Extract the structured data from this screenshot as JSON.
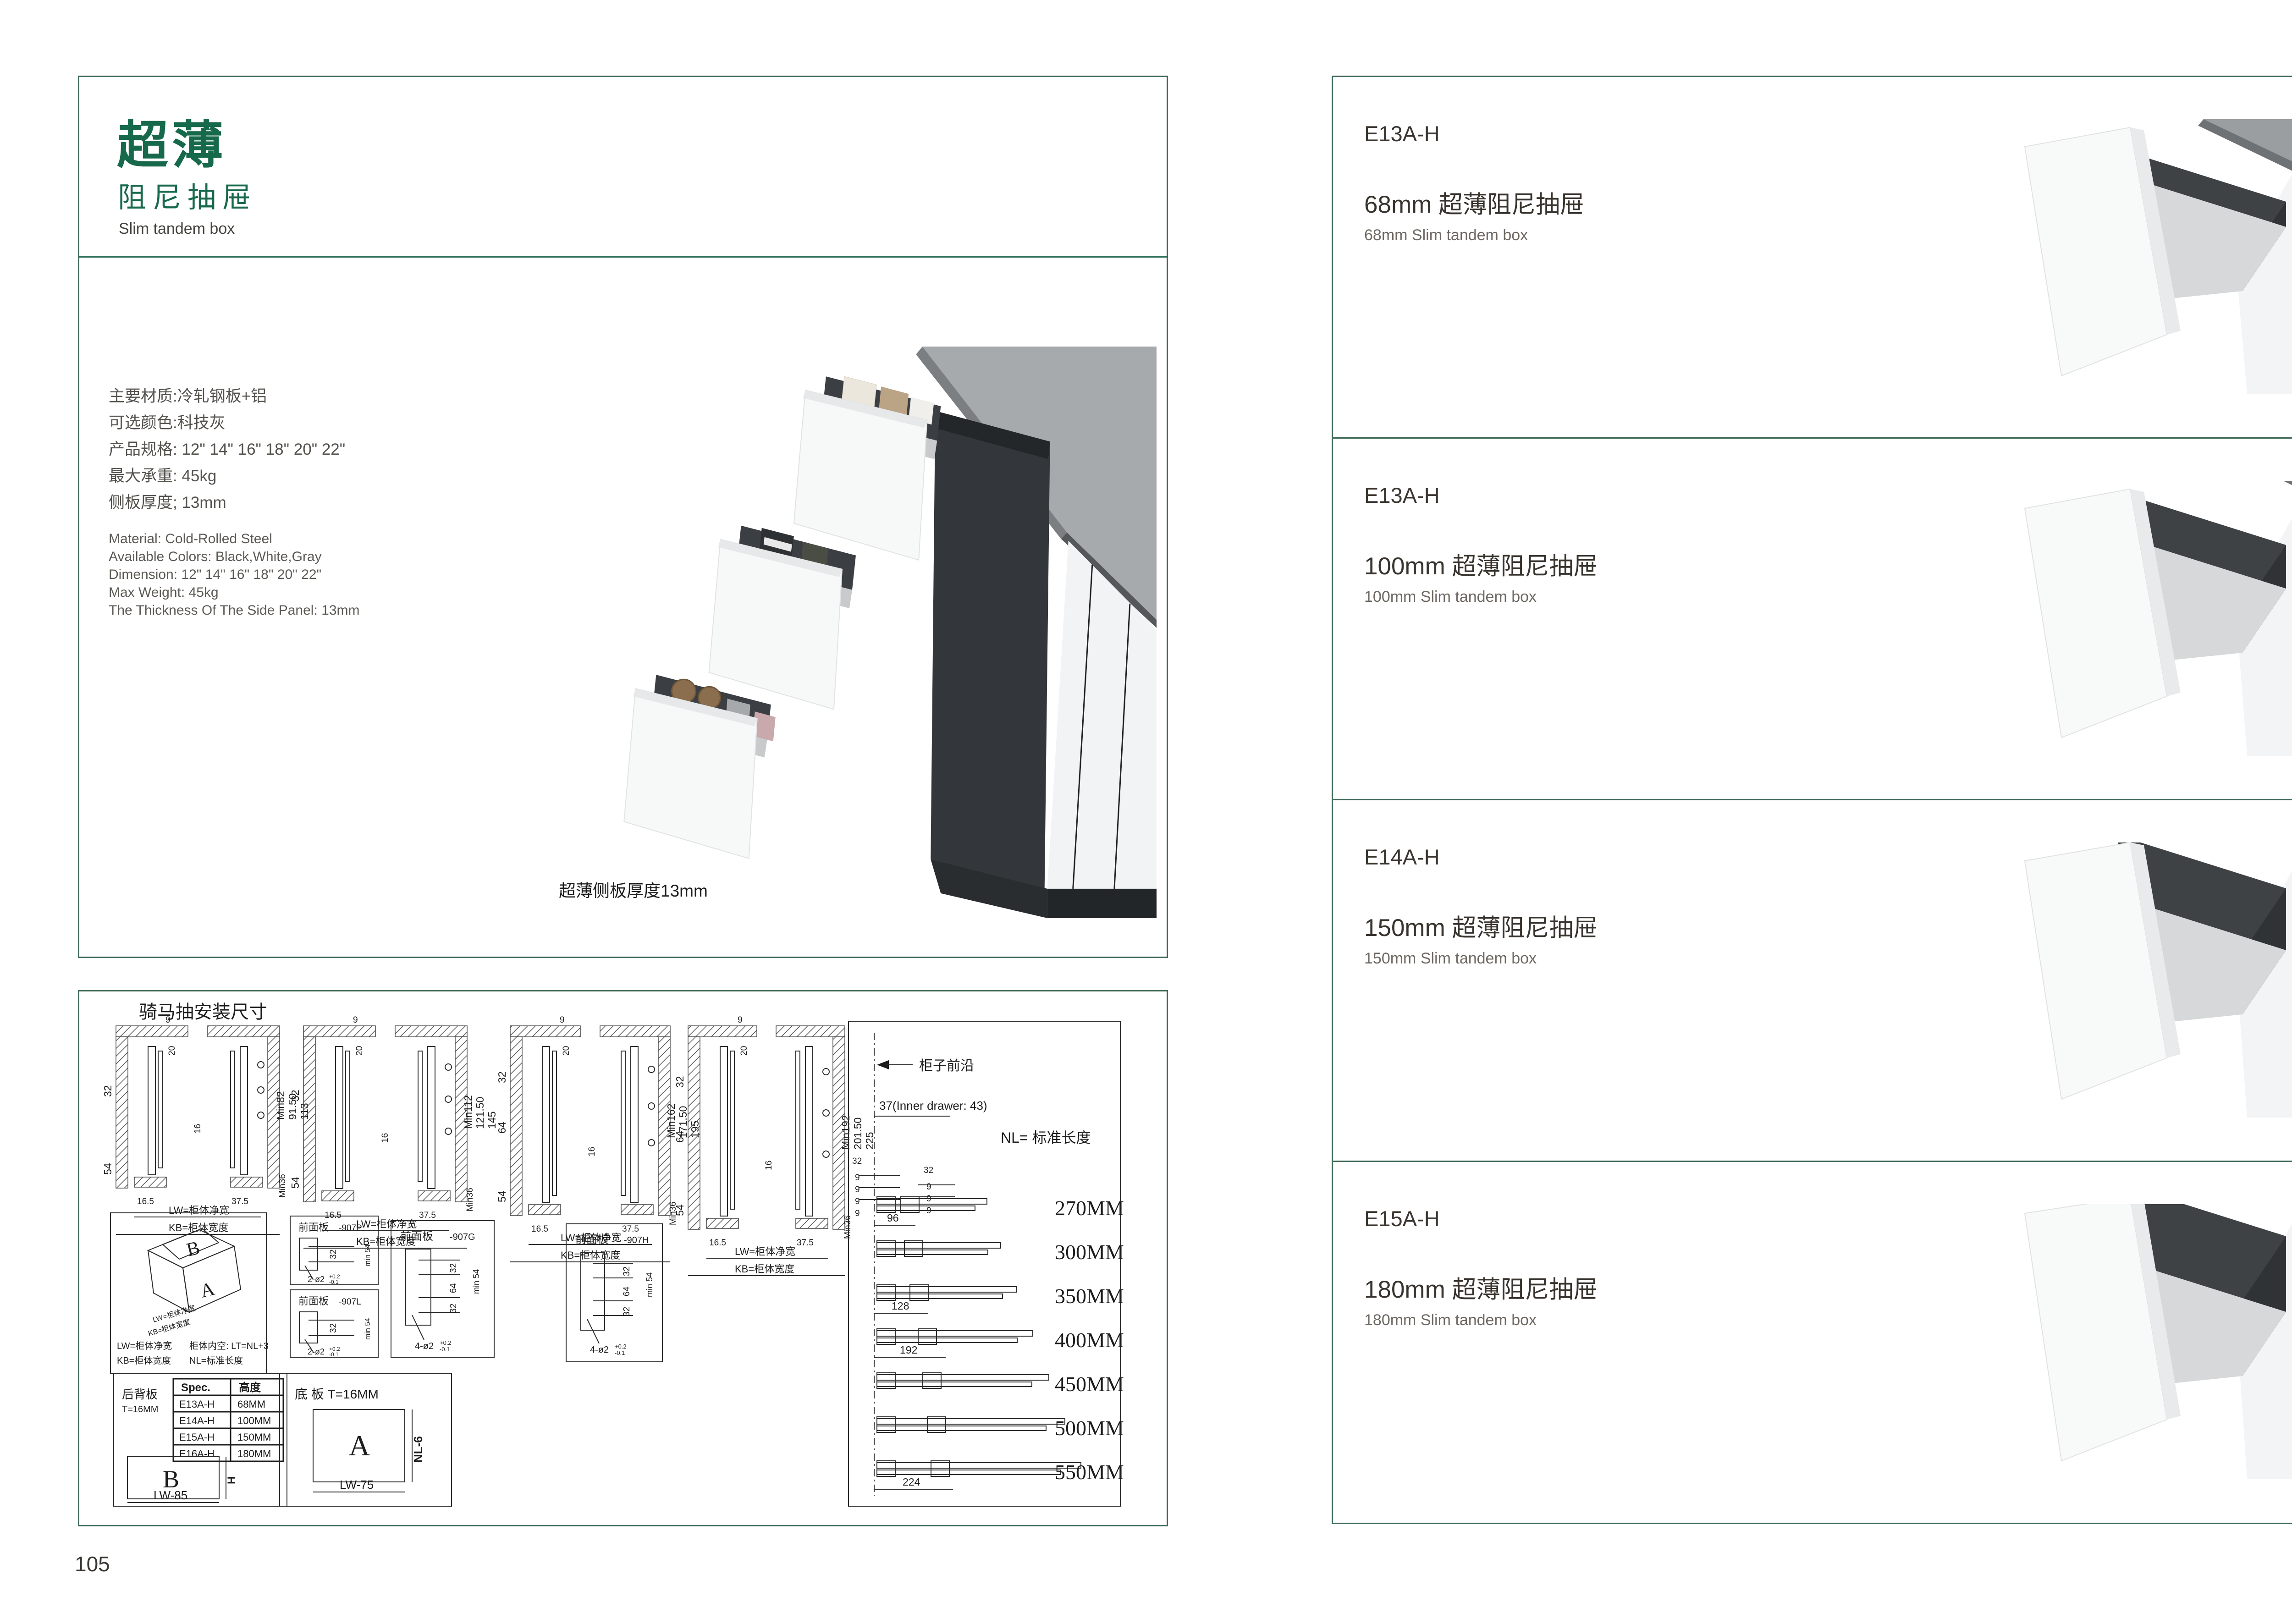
{
  "colors": {
    "green": "#17694B",
    "border_line": "#3f6b58",
    "drawer_dark": "#33373b",
    "counter_gray": "#a7aaac"
  },
  "page_left": {
    "page_number": "105",
    "header": {
      "title_cn_big": "超薄",
      "title_cn_sub": "阻尼抽屉",
      "title_en": "Slim tandem box"
    },
    "specs_cn": [
      "主要材质:冷轧钢板+铝",
      "可选颜色:科技灰",
      "产品规格: 12\" 14\" 16\" 18\" 20\" 22\"",
      "最大承重: 45kg",
      "侧板厚度; 13mm"
    ],
    "specs_en": [
      "Material: Cold-Rolled Steel",
      "Available Colors: Black,White,Gray",
      "Dimension: 12\" 14\" 16\" 18\" 20\" 22\"",
      "Max Weight: 45kg",
      "The Thickness Of The Side Panel: 13mm"
    ],
    "photo_caption": "超薄侧板厚度13mm",
    "diagram": {
      "title": "骑马抽安装尺寸",
      "cross_sections": [
        {
          "h1": "Min82",
          "h2": "91.50",
          "h3": "113",
          "d9": "9",
          "d20": "20",
          "d32": "32",
          "d16": "16",
          "d54": "54",
          "d165": "16.5",
          "d375": "37.5",
          "min36": "Min36",
          "lw": "LW=柜体净宽",
          "kb": "KB=柜体宽度"
        },
        {
          "h1": "Min112",
          "h2": "121.50",
          "h3": "145",
          "d9": "9",
          "d20": "20",
          "d32": "32",
          "d16": "16",
          "d54": "54",
          "d165": "16.5",
          "d375": "37.5",
          "min36": "Min36",
          "lw": "LW=柜体净宽",
          "kb": "KB=柜体宽度"
        },
        {
          "h1": "Min162",
          "h2": "171.50",
          "h3": "195",
          "d9": "9",
          "d20": "20",
          "d32": "32",
          "d64": "64",
          "d16": "16",
          "d54": "54",
          "d165": "16.5",
          "d375": "37.5",
          "min36": "Min36",
          "lw": "LW=柜体净宽",
          "kb": "KB=柜体宽度"
        },
        {
          "h1": "Min192",
          "h2": "201.50",
          "h3": "225",
          "d9": "9",
          "d20": "20",
          "d32": "32",
          "d64": "64",
          "d16": "16",
          "d54": "54",
          "d165": "16.5",
          "d375": "37.5",
          "min36": "Min36",
          "lw": "LW=柜体净宽",
          "kb": "KB=柜体宽度"
        }
      ],
      "iso": {
        "b": "B",
        "a": "A",
        "lab_lw": "LW=柜体净宽",
        "lab_kb": "KB=柜体宽度",
        "n1": "LW=柜体净宽",
        "n2": "柜体内空: LT=NL+3",
        "n3": "KB=柜体宽度",
        "n4": "NL=标准长度"
      },
      "panels": {
        "p907p": {
          "t": "前面板",
          "code": "-907P",
          "d32": "32",
          "min54": "min 54",
          "tol": "2-ø2",
          "tsup": "+0.2",
          "tsub": "-0.1"
        },
        "p907l": {
          "t": "前面板",
          "code": "-907L",
          "d32": "32",
          "min54": "min 54",
          "tol": "2-ø2",
          "tsup": "+0.2",
          "tsub": "-0.1"
        },
        "p907g": {
          "t": "前面板",
          "code": "-907G",
          "d32a": "32",
          "d64": "64",
          "d32b": "32",
          "min54": "min 54",
          "tol": "4-ø2",
          "tsup": "+0.2",
          "tsub": "-0.1"
        },
        "p907h": {
          "t": "前面板",
          "code": "-907H",
          "d32a": "32",
          "d64": "64",
          "d32b": "32",
          "min54": "min 54",
          "tol": "4-ø2",
          "tsup": "+0.2",
          "tsub": "-0.1"
        }
      },
      "back_panel": {
        "label": "后背板",
        "t": "T=16MM",
        "col1": "Spec.",
        "col2": "高度",
        "rows": [
          [
            "E13A-H",
            "68MM"
          ],
          [
            "E14A-H",
            "100MM"
          ],
          [
            "E15A-H",
            "150MM"
          ],
          [
            "E16A-H",
            "180MM"
          ]
        ],
        "letter": "B",
        "h": "H",
        "w": "LW-85"
      },
      "bottom_panel": {
        "label": "底 板 T=16MM",
        "letter": "A",
        "h": "NL-6",
        "w": "LW-75"
      },
      "chart": {
        "front": "柜子前沿",
        "inner": "37(Inner drawer: 43)",
        "nl": "NL= 标准长度",
        "l32a": "32",
        "l32b": "32",
        "l9a": "9",
        "l9b": "9",
        "l9c": "9",
        "l9d": "9",
        "r9a": "9",
        "r9b": "9",
        "r9c": "9",
        "lengths": [
          "270MM",
          "300MM",
          "350MM",
          "400MM",
          "450MM",
          "500MM",
          "550MM"
        ],
        "o96": "96",
        "o128": "128",
        "o192": "192",
        "o224": "224"
      }
    }
  },
  "page_right": {
    "page_number": "106",
    "products": [
      {
        "code": "E13A-H",
        "title_cn": "68mm 超薄阻尼抽屉",
        "title_en": "68mm Slim tandem box"
      },
      {
        "code": "E13A-H",
        "title_cn": "100mm 超薄阻尼抽屉",
        "title_en": "100mm Slim tandem box"
      },
      {
        "code": "E14A-H",
        "title_cn": "150mm 超薄阻尼抽屉",
        "title_en": "150mm Slim tandem box"
      },
      {
        "code": "E15A-H",
        "title_cn": "180mm 超薄阻尼抽屉",
        "title_en": "180mm Slim tandem box"
      }
    ]
  }
}
